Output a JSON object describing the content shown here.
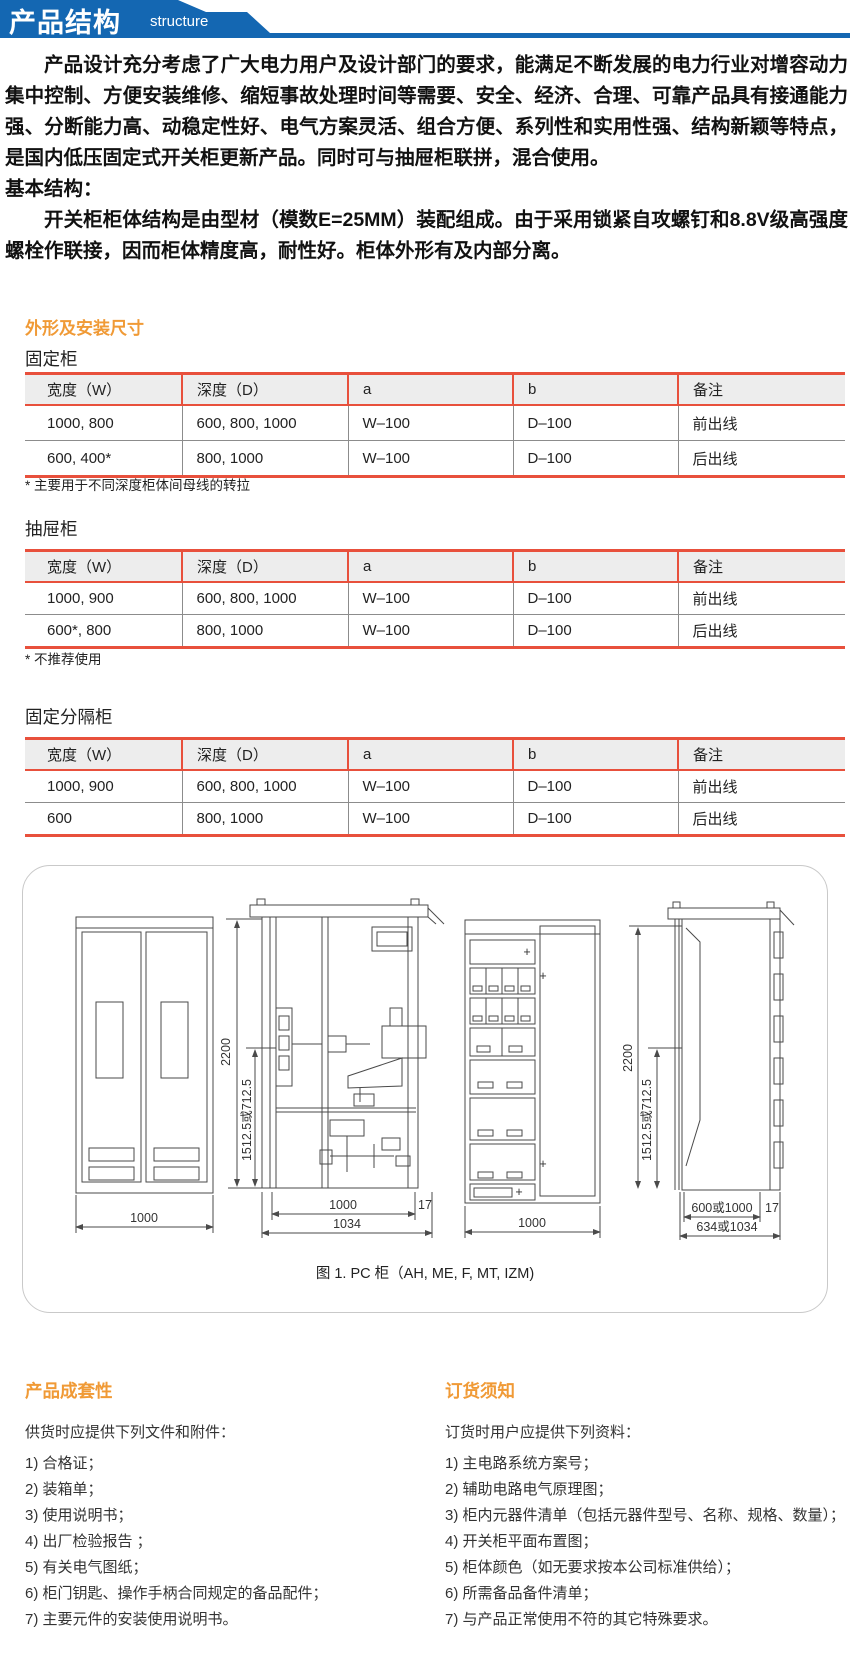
{
  "banner": {
    "title": "产品结构",
    "subtitle": "structure"
  },
  "intro": {
    "p1": "产品设计充分考虑了广大电力用户及设计部门的要求，能满足不断发展的电力行业对增容动力集中控制、方便安装维修、缩短事故处理时间等需要、安全、经济、合理、可靠产品具有接通能力强、分断能力高、动稳定性好、电气方案灵活、组合方便、系列性和实用性强、结构新颖等特点，是国内低压固定式开关柜更新产品。同时可与抽屉柜联拼，混合使用。",
    "basic_label": "基本结构：",
    "p2": "开关柜柜体结构是由型材（模数E=25MM）装配组成。由于采用锁紧自攻螺钉和8.8V级高强度螺栓作联接，因而柜体精度高，耐性好。柜体外形有及内部分离。"
  },
  "dimensions": {
    "section_title": "外形及安装尺寸",
    "headers": [
      "宽度（W）",
      "深度（D）",
      "a",
      "b",
      "备注"
    ],
    "tables": [
      {
        "name": "固定柜",
        "rows": [
          [
            "1000, 800",
            "600, 800, 1000",
            "W–100",
            "D–100",
            "前出线"
          ],
          [
            "600, 400*",
            "800, 1000",
            "W–100",
            "D–100",
            "后出线"
          ]
        ],
        "footnote": "* 主要用于不同深度柜体间母线的转拉"
      },
      {
        "name": "抽屉柜",
        "rows": [
          [
            "1000, 900",
            "600, 800, 1000",
            "W–100",
            "D–100",
            "前出线"
          ],
          [
            "600*, 800",
            "800, 1000",
            "W–100",
            "D–100",
            "后出线"
          ]
        ],
        "footnote": "* 不推荐使用"
      },
      {
        "name": "固定分隔柜",
        "rows": [
          [
            "1000, 900",
            "600, 800, 1000",
            "W–100",
            "D–100",
            "前出线"
          ],
          [
            "600",
            "800, 1000",
            "W–100",
            "D–100",
            "后出线"
          ]
        ],
        "footnote": ""
      }
    ]
  },
  "figure": {
    "caption": "图 1. PC 柜（AH, ME, F, MT, IZM)",
    "dims": {
      "front_width": "1000",
      "side_height": "2200",
      "side_partial_height": "1512.5或712.5",
      "side_inner_width": "1000",
      "side_gap": "17",
      "side_outer_width": "1034",
      "drawer_front_width": "1000",
      "side2_height": "2200",
      "side2_partial_height": "1512.5或712.5",
      "side2_inner_width": "600或1000",
      "side2_gap": "17",
      "side2_outer_width": "634或1034"
    }
  },
  "completeness": {
    "title": "产品成套性",
    "lead": "供货时应提供下列文件和附件：",
    "items": [
      "1) 合格证；",
      "2) 装箱单；",
      "3) 使用说明书；",
      "4) 出厂检验报告 ；",
      "5) 有关电气图纸；",
      "6) 柜门钥匙、操作手柄合同规定的备品配件；",
      "7) 主要元件的安装使用说明书。"
    ]
  },
  "ordering": {
    "title": "订货须知",
    "lead": "订货时用户应提供下列资料：",
    "items": [
      "1) 主电路系统方案号；",
      "2)  辅助电路电气原理图；",
      "3) 柜内元器件清单（包括元器件型号、名称、规格、数量）；",
      "4) 开关柜平面布置图；",
      "5) 柜体颜色（如无要求按本公司标准供给）；",
      "6) 所需备品备件清单；",
      "7) 与产品正常使用不符的其它特殊要求。"
    ]
  },
  "colors": {
    "banner_blue": "#1467b2",
    "accent_orange": "#f09a36",
    "table_red": "#e8503c"
  }
}
